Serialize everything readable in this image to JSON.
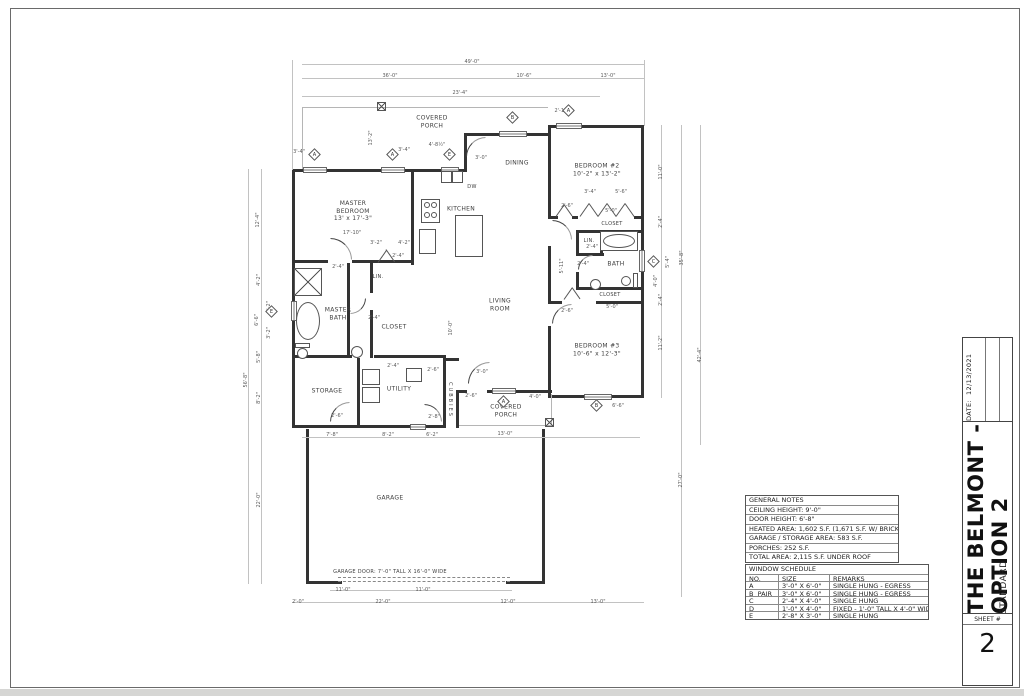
{
  "title_block": {
    "date_label": "DATE:",
    "date_value": "12/13/2021",
    "project_title": "THE BELMONT - OPTION 2",
    "subtitle": "STANDARD",
    "sheet_label": "SHEET #",
    "sheet_number": "2"
  },
  "general_notes": {
    "title": "GENERAL NOTES",
    "rows": [
      "CEILING HEIGHT:  9'-0\"",
      "DOOR HEIGHT:  6'-8\"",
      "HEATED AREA:  1,602 S.F.  (1,671 S.F. W/ BRICK)",
      "GARAGE / STORAGE AREA:  583 S.F.",
      "PORCHES:  252 S.F.",
      "TOTAL AREA:  2,115 S.F. UNDER ROOF"
    ]
  },
  "window_schedule": {
    "title": "WINDOW SCHEDULE",
    "headers": [
      "NO.",
      "SIZE",
      "REMARKS"
    ],
    "rows": [
      [
        "A",
        "3'-0\" X 6'-0\"",
        "SINGLE HUNG - EGRESS"
      ],
      [
        "B  PAIR",
        "3'-0\" X 6'-0\"",
        "SINGLE HUNG - EGRESS"
      ],
      [
        "C",
        "2'-4\" X 4'-0\"",
        "SINGLE HUNG"
      ],
      [
        "D",
        "1'-0\" X 4'-0\"",
        "FIXED - 1'-0\" TALL X 4'-0\" WIDE"
      ],
      [
        "E",
        "2'-8\" X 3'-0\"",
        "SINGLE HUNG"
      ]
    ]
  },
  "plan": {
    "walls": [
      [
        292,
        169,
        175,
        3
      ],
      [
        464,
        133,
        3,
        39
      ],
      [
        464,
        133,
        87,
        3
      ],
      [
        548,
        125,
        3,
        11
      ],
      [
        548,
        125,
        96,
        3
      ],
      [
        641,
        125,
        3,
        273
      ],
      [
        548,
        395,
        96,
        3
      ],
      [
        292,
        169,
        3,
        259
      ],
      [
        292,
        425,
        154,
        3
      ],
      [
        459,
        390,
        8,
        3
      ],
      [
        487,
        390,
        65,
        3
      ],
      [
        443,
        358,
        3,
        70
      ],
      [
        456,
        390,
        3,
        38
      ],
      [
        443,
        358,
        16,
        3
      ],
      [
        357,
        358,
        3,
        70
      ],
      [
        292,
        260,
        36,
        3
      ],
      [
        352,
        260,
        62,
        3
      ],
      [
        347,
        263,
        3,
        95
      ],
      [
        292,
        355,
        60,
        3
      ],
      [
        374,
        355,
        72,
        3
      ],
      [
        411,
        169,
        3,
        96
      ],
      [
        370,
        263,
        3,
        30
      ],
      [
        370,
        310,
        3,
        48
      ],
      [
        548,
        133,
        3,
        85
      ],
      [
        548,
        246,
        3,
        57
      ],
      [
        548,
        326,
        3,
        69
      ],
      [
        548,
        216,
        10,
        3
      ],
      [
        572,
        216,
        6,
        3
      ],
      [
        634,
        216,
        10,
        3
      ],
      [
        576,
        230,
        68,
        3
      ],
      [
        576,
        233,
        3,
        22
      ],
      [
        600,
        233,
        3,
        22
      ],
      [
        576,
        253,
        28,
        3
      ],
      [
        576,
        272,
        3,
        18
      ],
      [
        576,
        287,
        68,
        3
      ],
      [
        548,
        301,
        14,
        3
      ],
      [
        596,
        301,
        48,
        3
      ],
      [
        306,
        429,
        3,
        152
      ],
      [
        542,
        429,
        3,
        152
      ],
      [
        306,
        581,
        36,
        3
      ],
      [
        506,
        581,
        39,
        3
      ]
    ],
    "windows": [
      [
        303,
        167,
        24,
        6
      ],
      [
        381,
        167,
        24,
        6
      ],
      [
        441,
        167,
        18,
        6
      ],
      [
        499,
        131,
        28,
        6
      ],
      [
        556,
        123,
        26,
        6
      ],
      [
        639,
        250,
        6,
        22
      ],
      [
        291,
        301,
        6,
        20
      ],
      [
        492,
        388,
        24,
        6
      ],
      [
        584,
        394,
        28,
        6
      ],
      [
        410,
        424,
        16,
        6
      ]
    ],
    "thin": [
      [
        302,
        107,
        246,
        1
      ],
      [
        302,
        107,
        1,
        62
      ],
      [
        459,
        425,
        93,
        1
      ],
      [
        551,
        394,
        1,
        31
      ]
    ],
    "dimlines": [
      [
        302,
        64,
        342,
        1
      ],
      [
        302,
        78,
        342,
        1
      ],
      [
        302,
        96,
        298,
        1
      ],
      [
        292,
        60,
        1,
        110
      ],
      [
        644,
        60,
        1,
        66
      ],
      [
        248,
        169,
        1,
        415
      ],
      [
        261,
        169,
        1,
        415
      ],
      [
        661,
        125,
        1,
        273
      ],
      [
        681,
        125,
        1,
        472
      ],
      [
        700,
        125,
        1,
        320
      ],
      [
        302,
        437,
        338,
        1
      ],
      [
        330,
        590,
        182,
        1
      ],
      [
        292,
        602,
        352,
        1
      ]
    ],
    "labels": [
      {
        "t": "MASTER\nBEDROOM\n13' x 17'-3\"",
        "x": 353,
        "y": 211
      },
      {
        "t": "17'-10\"",
        "x": 352,
        "y": 233,
        "d": 1
      },
      {
        "t": "KITCHEN",
        "x": 461,
        "y": 209
      },
      {
        "t": "DINING",
        "x": 517,
        "y": 163
      },
      {
        "t": "BEDROOM #2\n10'-2\" x 13'-2\"",
        "x": 597,
        "y": 170
      },
      {
        "t": "LIVING\nROOM",
        "x": 500,
        "y": 305
      },
      {
        "t": "BEDROOM #3\n10'-6\" x 12'-3\"",
        "x": 597,
        "y": 350
      },
      {
        "t": "MASTER\nBATH",
        "x": 338,
        "y": 314
      },
      {
        "t": "CLOSET",
        "x": 394,
        "y": 327
      },
      {
        "t": "CLOSET",
        "x": 612,
        "y": 224,
        "s": 5
      },
      {
        "t": "BATH",
        "x": 616,
        "y": 264
      },
      {
        "t": "LIN.",
        "x": 589,
        "y": 241,
        "s": 5
      },
      {
        "t": "LIN.",
        "x": 378,
        "y": 277,
        "s": 5
      },
      {
        "t": "CLOSET",
        "x": 610,
        "y": 295,
        "s": 5
      },
      {
        "t": "STORAGE",
        "x": 327,
        "y": 391
      },
      {
        "t": "UTILITY",
        "x": 399,
        "y": 389
      },
      {
        "t": "COVERED\nPORCH",
        "x": 432,
        "y": 122
      },
      {
        "t": "COVERED\nPORCH",
        "x": 506,
        "y": 411
      },
      {
        "t": "GARAGE",
        "x": 390,
        "y": 498
      },
      {
        "t": "GARAGE DOOR: 7'-0\" TALL X 16'-0\" WIDE",
        "x": 390,
        "y": 572,
        "s": 5
      },
      {
        "t": "CUBBIES",
        "x": 450,
        "y": 400,
        "r": 2,
        "s": 5,
        "ls": 2
      },
      {
        "t": "DW",
        "x": 472,
        "y": 187,
        "s": 5
      },
      {
        "t": "REF.",
        "x": 427,
        "y": 241,
        "s": 5
      },
      {
        "t": "B.C.",
        "x": 414,
        "y": 375,
        "s": 5
      },
      {
        "t": "D",
        "x": 371,
        "y": 377,
        "s": 5
      },
      {
        "t": "W",
        "x": 371,
        "y": 395,
        "s": 5
      },
      {
        "t": "49'-0\"",
        "x": 472,
        "y": 62,
        "d": 1
      },
      {
        "t": "36'-0\"",
        "x": 390,
        "y": 76,
        "d": 1
      },
      {
        "t": "10'-6\"",
        "x": 524,
        "y": 76,
        "d": 1
      },
      {
        "t": "13'-0\"",
        "x": 608,
        "y": 76,
        "d": 1
      },
      {
        "t": "23'-4\"",
        "x": 460,
        "y": 93,
        "d": 1
      },
      {
        "t": "2'-10\"",
        "x": 562,
        "y": 111,
        "d": 1
      },
      {
        "t": "3'-4\"",
        "x": 299,
        "y": 152,
        "d": 1
      },
      {
        "t": "3'-4\"",
        "x": 404,
        "y": 150,
        "d": 1
      },
      {
        "t": "4'-8½\"",
        "x": 437,
        "y": 145,
        "d": 1
      },
      {
        "t": "3'-0\"",
        "x": 481,
        "y": 158,
        "d": 1
      },
      {
        "t": "13'-2\"",
        "x": 371,
        "y": 138,
        "r": 1,
        "d": 1
      },
      {
        "t": "11'-0\"",
        "x": 661,
        "y": 172,
        "r": 1,
        "d": 1
      },
      {
        "t": "2'-4\"",
        "x": 661,
        "y": 222,
        "r": 1,
        "d": 1
      },
      {
        "t": "4'-0\"",
        "x": 656,
        "y": 281,
        "r": 1,
        "d": 1
      },
      {
        "t": "5'-4\"",
        "x": 668,
        "y": 262,
        "r": 1,
        "d": 1
      },
      {
        "t": "35'-8\"",
        "x": 682,
        "y": 258,
        "r": 1,
        "d": 1
      },
      {
        "t": "2'-4\"",
        "x": 661,
        "y": 300,
        "r": 1,
        "d": 1
      },
      {
        "t": "11'-2\"",
        "x": 661,
        "y": 343,
        "r": 1,
        "d": 1
      },
      {
        "t": "42'-4\"",
        "x": 700,
        "y": 355,
        "r": 1,
        "d": 1
      },
      {
        "t": "27'-0\"",
        "x": 681,
        "y": 480,
        "r": 1,
        "d": 1
      },
      {
        "t": "12'-4\"",
        "x": 258,
        "y": 220,
        "r": 1,
        "d": 1
      },
      {
        "t": "4'-2\"",
        "x": 259,
        "y": 280,
        "r": 1,
        "d": 1
      },
      {
        "t": "3'-2\"",
        "x": 269,
        "y": 307,
        "r": 1,
        "d": 1
      },
      {
        "t": "3'-2\"",
        "x": 269,
        "y": 333,
        "r": 1,
        "d": 1
      },
      {
        "t": "6'-6\"",
        "x": 257,
        "y": 320,
        "r": 1,
        "d": 1
      },
      {
        "t": "5'-8\"",
        "x": 259,
        "y": 357,
        "r": 1,
        "d": 1
      },
      {
        "t": "8'-2\"",
        "x": 259,
        "y": 398,
        "r": 1,
        "d": 1
      },
      {
        "t": "56'-8\"",
        "x": 246,
        "y": 380,
        "r": 1,
        "d": 1
      },
      {
        "t": "22'-0\"",
        "x": 259,
        "y": 500,
        "r": 1,
        "d": 1
      },
      {
        "t": "3'-4\"",
        "x": 590,
        "y": 192,
        "d": 1
      },
      {
        "t": "5'-6\"",
        "x": 621,
        "y": 192,
        "d": 1
      },
      {
        "t": "5'-0\"",
        "x": 611,
        "y": 211,
        "d": 1
      },
      {
        "t": "2'-6\"",
        "x": 567,
        "y": 206,
        "d": 1
      },
      {
        "t": "2'-4\"",
        "x": 592,
        "y": 247,
        "d": 1
      },
      {
        "t": "2'-4\"",
        "x": 583,
        "y": 264,
        "d": 1
      },
      {
        "t": "5'-11\"",
        "x": 562,
        "y": 266,
        "r": 1,
        "d": 1
      },
      {
        "t": "2'-6\"",
        "x": 567,
        "y": 311,
        "d": 1
      },
      {
        "t": "5'-0\"",
        "x": 612,
        "y": 307,
        "d": 1
      },
      {
        "t": "6'-6\"",
        "x": 618,
        "y": 406,
        "d": 1
      },
      {
        "t": "3'-2\"",
        "x": 376,
        "y": 243,
        "d": 1
      },
      {
        "t": "4'-2\"",
        "x": 404,
        "y": 243,
        "d": 1
      },
      {
        "t": "2'-4\"",
        "x": 338,
        "y": 267,
        "d": 1
      },
      {
        "t": "2'-4\"",
        "x": 398,
        "y": 256,
        "d": 1
      },
      {
        "t": "2'-4\"",
        "x": 374,
        "y": 318,
        "d": 1
      },
      {
        "t": "2'-4\"",
        "x": 393,
        "y": 366,
        "d": 1
      },
      {
        "t": "2'-6\"",
        "x": 433,
        "y": 370,
        "d": 1
      },
      {
        "t": "2'-6\"",
        "x": 337,
        "y": 416,
        "d": 1
      },
      {
        "t": "2'-8\"",
        "x": 434,
        "y": 417,
        "d": 1
      },
      {
        "t": "10'-0\"",
        "x": 451,
        "y": 328,
        "r": 1,
        "d": 1
      },
      {
        "t": "3'-0\"",
        "x": 482,
        "y": 372,
        "d": 1
      },
      {
        "t": "2'-6\"",
        "x": 471,
        "y": 396,
        "d": 1
      },
      {
        "t": "4'-0\"",
        "x": 535,
        "y": 397,
        "d": 1
      },
      {
        "t": "13'-0\"",
        "x": 505,
        "y": 434,
        "d": 1
      },
      {
        "t": "7'-8\"",
        "x": 332,
        "y": 435,
        "d": 1
      },
      {
        "t": "8'-2\"",
        "x": 388,
        "y": 435,
        "d": 1
      },
      {
        "t": "6'-2\"",
        "x": 432,
        "y": 435,
        "d": 1
      },
      {
        "t": "11'-0\"",
        "x": 343,
        "y": 590,
        "d": 1
      },
      {
        "t": "11'-0\"",
        "x": 423,
        "y": 590,
        "d": 1
      },
      {
        "t": "2'-0\"",
        "x": 298,
        "y": 602,
        "d": 1
      },
      {
        "t": "22'-0\"",
        "x": 383,
        "y": 602,
        "d": 1
      },
      {
        "t": "12'-0\"",
        "x": 508,
        "y": 602,
        "d": 1
      },
      {
        "t": "13'-0\"",
        "x": 598,
        "y": 602,
        "d": 1
      }
    ],
    "tags": [
      {
        "t": "A",
        "x": 315,
        "y": 155
      },
      {
        "t": "A",
        "x": 393,
        "y": 155
      },
      {
        "t": "E",
        "x": 450,
        "y": 155
      },
      {
        "t": "B",
        "x": 513,
        "y": 118
      },
      {
        "t": "A",
        "x": 569,
        "y": 111
      },
      {
        "t": "C",
        "x": 654,
        "y": 262
      },
      {
        "t": "E",
        "x": 272,
        "y": 312
      },
      {
        "t": "A",
        "x": 504,
        "y": 402
      },
      {
        "t": "B",
        "x": 597,
        "y": 406
      }
    ],
    "fixtures": [
      {
        "k": "xbox",
        "x": 294,
        "y": 268,
        "w": 28,
        "h": 28
      },
      {
        "k": "oval",
        "x": 296,
        "y": 302,
        "w": 24,
        "h": 38
      },
      {
        "k": "rect",
        "x": 295,
        "y": 343,
        "w": 15,
        "h": 5
      },
      {
        "k": "circle",
        "x": 297,
        "y": 348,
        "w": 11
      },
      {
        "k": "circle",
        "x": 351,
        "y": 346,
        "w": 12
      },
      {
        "k": "rect",
        "x": 600,
        "y": 231,
        "w": 38,
        "h": 20
      },
      {
        "k": "oval",
        "x": 603,
        "y": 234,
        "w": 32,
        "h": 14
      },
      {
        "k": "circle",
        "x": 590,
        "y": 279,
        "w": 11
      },
      {
        "k": "rect",
        "x": 633,
        "y": 273,
        "w": 5,
        "h": 15
      },
      {
        "k": "circle",
        "x": 621,
        "y": 276,
        "w": 10
      },
      {
        "k": "rect",
        "x": 419,
        "y": 229,
        "w": 17,
        "h": 25
      },
      {
        "k": "rect",
        "x": 421,
        "y": 199,
        "w": 19,
        "h": 24
      },
      {
        "k": "circle",
        "x": 424,
        "y": 202,
        "w": 6
      },
      {
        "k": "circle",
        "x": 431,
        "y": 202,
        "w": 6
      },
      {
        "k": "circle",
        "x": 424,
        "y": 212,
        "w": 6
      },
      {
        "k": "circle",
        "x": 431,
        "y": 212,
        "w": 6
      },
      {
        "k": "rect",
        "x": 441,
        "y": 171,
        "w": 11,
        "h": 12
      },
      {
        "k": "rect",
        "x": 452,
        "y": 171,
        "w": 11,
        "h": 12
      },
      {
        "k": "rect",
        "x": 455,
        "y": 215,
        "w": 28,
        "h": 42
      },
      {
        "k": "rect",
        "x": 362,
        "y": 369,
        "w": 18,
        "h": 16
      },
      {
        "k": "rect",
        "x": 362,
        "y": 387,
        "w": 18,
        "h": 16
      },
      {
        "k": "rect",
        "x": 406,
        "y": 368,
        "w": 16,
        "h": 14
      },
      {
        "k": "xbox",
        "x": 377,
        "y": 102,
        "w": 9,
        "h": 9
      },
      {
        "k": "xbox",
        "x": 545,
        "y": 418,
        "w": 9,
        "h": 9
      },
      {
        "k": "dash",
        "x": 338,
        "y": 577,
        "l": 172
      },
      {
        "k": "dash",
        "x": 338,
        "y": 581,
        "l": 172
      },
      {
        "k": "arc",
        "x": 466,
        "y": 137,
        "s": 20,
        "r": 0
      },
      {
        "k": "arc",
        "x": 330,
        "y": 238,
        "s": 22,
        "r": 90
      },
      {
        "k": "arc",
        "x": 350,
        "y": 298,
        "s": 16,
        "r": 180
      },
      {
        "k": "arc",
        "x": 552,
        "y": 220,
        "s": 20,
        "r": 90
      },
      {
        "k": "arc",
        "x": 552,
        "y": 304,
        "s": 20,
        "r": 0
      },
      {
        "k": "arc",
        "x": 578,
        "y": 255,
        "s": 15,
        "r": 0
      },
      {
        "k": "arc",
        "x": 468,
        "y": 362,
        "s": 22,
        "r": 0
      },
      {
        "k": "arc",
        "x": 330,
        "y": 402,
        "s": 20,
        "r": 0
      },
      {
        "k": "arc",
        "x": 424,
        "y": 404,
        "s": 18,
        "r": 90
      },
      {
        "k": "diag",
        "x": 378,
        "y": 262,
        "l": 15,
        "a": -55
      },
      {
        "k": "diag",
        "x": 386,
        "y": 249,
        "l": 15,
        "a": 55
      },
      {
        "k": "diag",
        "x": 556,
        "y": 216,
        "l": 14,
        "a": -55
      },
      {
        "k": "diag",
        "x": 564,
        "y": 204,
        "l": 14,
        "a": 55
      },
      {
        "k": "diag",
        "x": 580,
        "y": 216,
        "l": 16,
        "a": -55
      },
      {
        "k": "diag",
        "x": 589,
        "y": 203,
        "l": 16,
        "a": 55
      },
      {
        "k": "diag",
        "x": 598,
        "y": 216,
        "l": 16,
        "a": -55
      },
      {
        "k": "diag",
        "x": 607,
        "y": 203,
        "l": 16,
        "a": 55
      },
      {
        "k": "diag",
        "x": 616,
        "y": 216,
        "l": 16,
        "a": -55
      },
      {
        "k": "diag",
        "x": 625,
        "y": 203,
        "l": 16,
        "a": 55
      },
      {
        "k": "diag",
        "x": 564,
        "y": 299,
        "l": 14,
        "a": -55
      },
      {
        "k": "diag",
        "x": 572,
        "y": 287,
        "l": 14,
        "a": 55
      }
    ]
  }
}
